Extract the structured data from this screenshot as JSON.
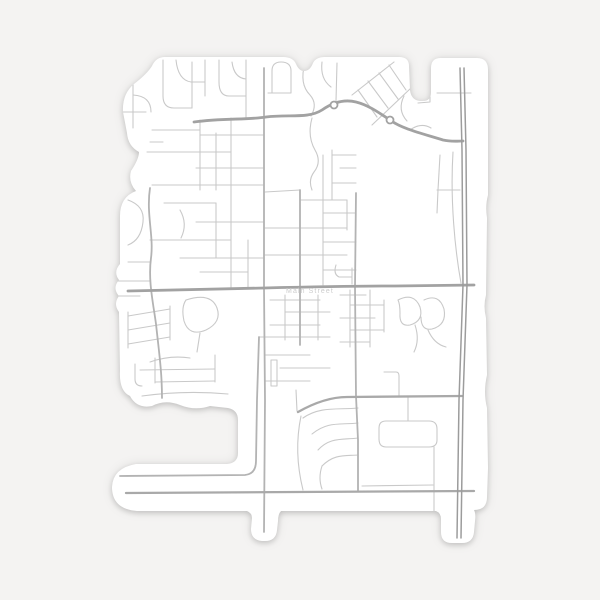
{
  "scene": {
    "background_color": "#f4f3f2",
    "description": "die-cut city street map sticker on plain light-gray background"
  },
  "sticker": {
    "fill": "#ffffff",
    "outline_path": "M165,57 L283,57 Q293,57 296,64 Q299,71 304,71 Q310,71 313,63 Q316,57 325,57 L399,57 Q409,57 409,66 L410,90 Q411,100 420,101 L423,101 Q431,101 431,92 L431,68 Q431,58 441,58 L477,58 Q488,58 488,70 L488,195 Q485,206 487,218 L486,295 Q483,306 486,318 L487,375 Q483,392 487,408 L488,468 L487,497 Q487,510 474,510 Q476,514 475,521 L474,532 Q473,543 462,543 L452,543 Q441,543 441,532 L441,519 Q441,513 436,511 L281,511 Q278,514 278,521 L277,530 Q276,541 265,541 L262,541 Q251,540 251,529 L252,518 Q252,513 247,511 L137,511 Q112,509 112,487 Q113,468 136,464 L227,464 Q238,463 238,453 L238,420 Q238,410 228,408 L210,406 Q195,411 180,405 Q165,399 152,406 Q137,409 130,396 Q119,391 120,371 L119,312 Q113,304 119,296 Q112,288 119,280 Q113,272 120,264 L120,216 Q120,197 136,191 Q128,182 131,171 Q139,159 139,152 Q128,146 127,133 L123,112 Q122,94 134,84 Q147,74 152,66 Q156,57 165,57 Z"
  },
  "map": {
    "label": {
      "text": "Main Street",
      "color": "#cccccc",
      "x": 310,
      "y": 293
    },
    "road_styles": {
      "minor": {
        "color": "#c9c9c9",
        "width": 1.1
      },
      "medium": {
        "color": "#b3b3b3",
        "width": 1.8
      },
      "arterial": {
        "color": "#a9a9a9",
        "width": 2.3
      },
      "major": {
        "color": "#a2a2a2",
        "width": 2.8
      },
      "highway": {
        "color": "#9c9c9c",
        "width": 1.5
      }
    },
    "roundabouts": [
      {
        "cx": 334,
        "cy": 105,
        "r": 3.5
      },
      {
        "cx": 390,
        "cy": 120,
        "r": 3.5
      }
    ],
    "roads": {
      "major": [
        "M128,291 C180,290 225,289 264,288 C305,287 350,286 395,286 L474,285",
        "M194,122 C222,118 248,120 266,117 C288,114 308,119 322,110 C332,103 344,99 356,102 C368,105 378,112 390,120 C402,129 424,134 443,140 C452,142 458,141 463,141"
      ],
      "arterial": [
        "M126,493 L474,491",
        "M298,412 C314,403 331,397 347,397 L462,396"
      ],
      "highway": [
        "M460,68 L462,150 L463,285 L459,400 L457,538",
        "M464,68 L466,150 L467,285 L463,400 L461,538"
      ],
      "medium": [
        "M264,68 L264,288 L265,400 L264,532",
        "M150,188 C146,214 154,236 151,258 C148,280 153,302 156,324 C159,352 162,372 162,398",
        "M259,337 L257,400 L256,461 Q256,474 245,475 L120,476",
        "M356,193 L355,287 L356,396 L358,440 L358,491",
        "M300,190 L300,288 L300,345"
      ],
      "minor": [
        "M133,78 L133,128",
        "M122,112 L146,112",
        "M133,95 Q151,96 151,112",
        "M163,60 L163,96 Q163,108 174,108 L192,108",
        "M176,60 Q178,80 191,82 L205,82",
        "M192,62 L192,108",
        "M205,60 L205,96",
        "M219,60 L219,82 Q219,96 229,96 L246,96",
        "M232,62 Q234,78 246,79",
        "M246,60 L246,118",
        "M268,93 L291,93 L291,71 Q291,62 281,62 Q272,62 272,71 L272,93",
        "M152,130 L200,130",
        "M150,142 L163,142",
        "M200,120 L200,190",
        "M216,133 L216,190",
        "M231,118 L231,190",
        "M200,135 L264,135",
        "M147,152 L231,152",
        "M196,168 L264,168",
        "M152,185 L264,185",
        "M164,203 L216,203",
        "M196,222 L264,222",
        "M150,240 L231,240",
        "M180,258 L264,258",
        "M200,272 L248,272",
        "M231,190 L231,288",
        "M248,240 L248,288",
        "M216,203 L216,258",
        "M128,200 Q145,206 143,222 Q141,240 128,245",
        "M128,262 L150,262",
        "M117,281 L150,281",
        "M119,296 L140,296",
        "M180,210 Q188,224 181,238",
        "M305,63 Q299,84 310,95 Q318,104 311,116",
        "M322,62 Q320,79 331,87",
        "M337,63 L336,101",
        "M312,118 Q307,136 315,150 Q322,162 314,172 Q308,180 312,190",
        "M352,95 L394,62",
        "M372,125 L411,88",
        "M358,90 L377,117",
        "M368,81 L388,108",
        "M379,73 L398,99",
        "M389,65 L406,90",
        "M404,96 Q397,110 407,121",
        "M430,62 L430,102 L418,103",
        "M437,93 L471,93",
        "M440,155 L438,190 L437,213",
        "M437,190 L460,190",
        "M453,152 C450,200 455,250 461,283",
        "M410,130 Q421,122 431,128",
        "M265,192 L300,190",
        "M332,150 L332,200",
        "M332,155 L356,155",
        "M340,168 L356,168",
        "M332,183 L356,183",
        "M300,200 L347,200",
        "M323,213 L356,213",
        "M264,228 L347,228",
        "M323,242 L356,242",
        "M264,255 L347,255",
        "M323,270 L356,270",
        "M323,155 L323,285",
        "M347,200 L347,230",
        "M336,265 Q333,274 339,277 L352,277",
        "M352,268 L352,284",
        "M270,300 L320,300",
        "M285,312 L330,312",
        "M270,325 L320,325",
        "M259,337 L330,337",
        "M285,295 L285,340",
        "M318,295 L318,340",
        "M265,355 L310,355",
        "M280,368 L330,368",
        "M265,381 L310,381",
        "M271,360 L277,360 L277,386 L271,386 L271,360",
        "M296,390 L297,411",
        "M128,316 L170,309",
        "M128,330 L170,323",
        "M128,344 L170,337",
        "M128,312 L128,348",
        "M170,306 L170,340",
        "M186,300 Q211,292 217,308 Q222,322 206,330 Q189,337 184,321 Q181,307 186,300",
        "M200,333 L197,352",
        "M150,362 Q170,355 190,358",
        "M140,370 L215,369",
        "M155,382 L215,381",
        "M215,355 L215,382",
        "M155,358 L155,383",
        "M135,364 L135,379 Q135,386 142,386",
        "M142,396 Q185,390 228,394",
        "M358,408 C338,410 320,406 303,418",
        "M358,423 C340,425 328,421 312,434",
        "M358,438 C342,440 330,437 318,450",
        "M358,455 C344,456 334,454 322,466",
        "M301,416 C296,440 297,466 303,490",
        "M322,466 Q318,478 322,489",
        "M340,295 L366,295",
        "M350,305 L384,305",
        "M340,318 L375,318",
        "M350,330 L384,330",
        "M340,342 L370,342",
        "M350,290 L350,347",
        "M370,290 L370,347",
        "M384,300 L384,332",
        "M398,300 Q414,292 420,307 Q424,321 410,325 Q399,327 400,313 Q400,304 398,300",
        "M424,300 Q439,293 444,309 Q447,325 432,329 Q421,331 421,317",
        "M428,330 Q434,344 446,347",
        "M415,325 Q420,340 414,352",
        "M384,372 L396,372 Q399,372 399,376 L399,396",
        "M386,421 L429,421 Q437,421 437,429 L437,440 Q437,447 429,447 L386,447 Q379,447 379,439 L379,428 Q379,421 386,421",
        "M434,447 L434,530",
        "M362,486 L433,485",
        "M408,397 L408,421"
      ]
    }
  }
}
